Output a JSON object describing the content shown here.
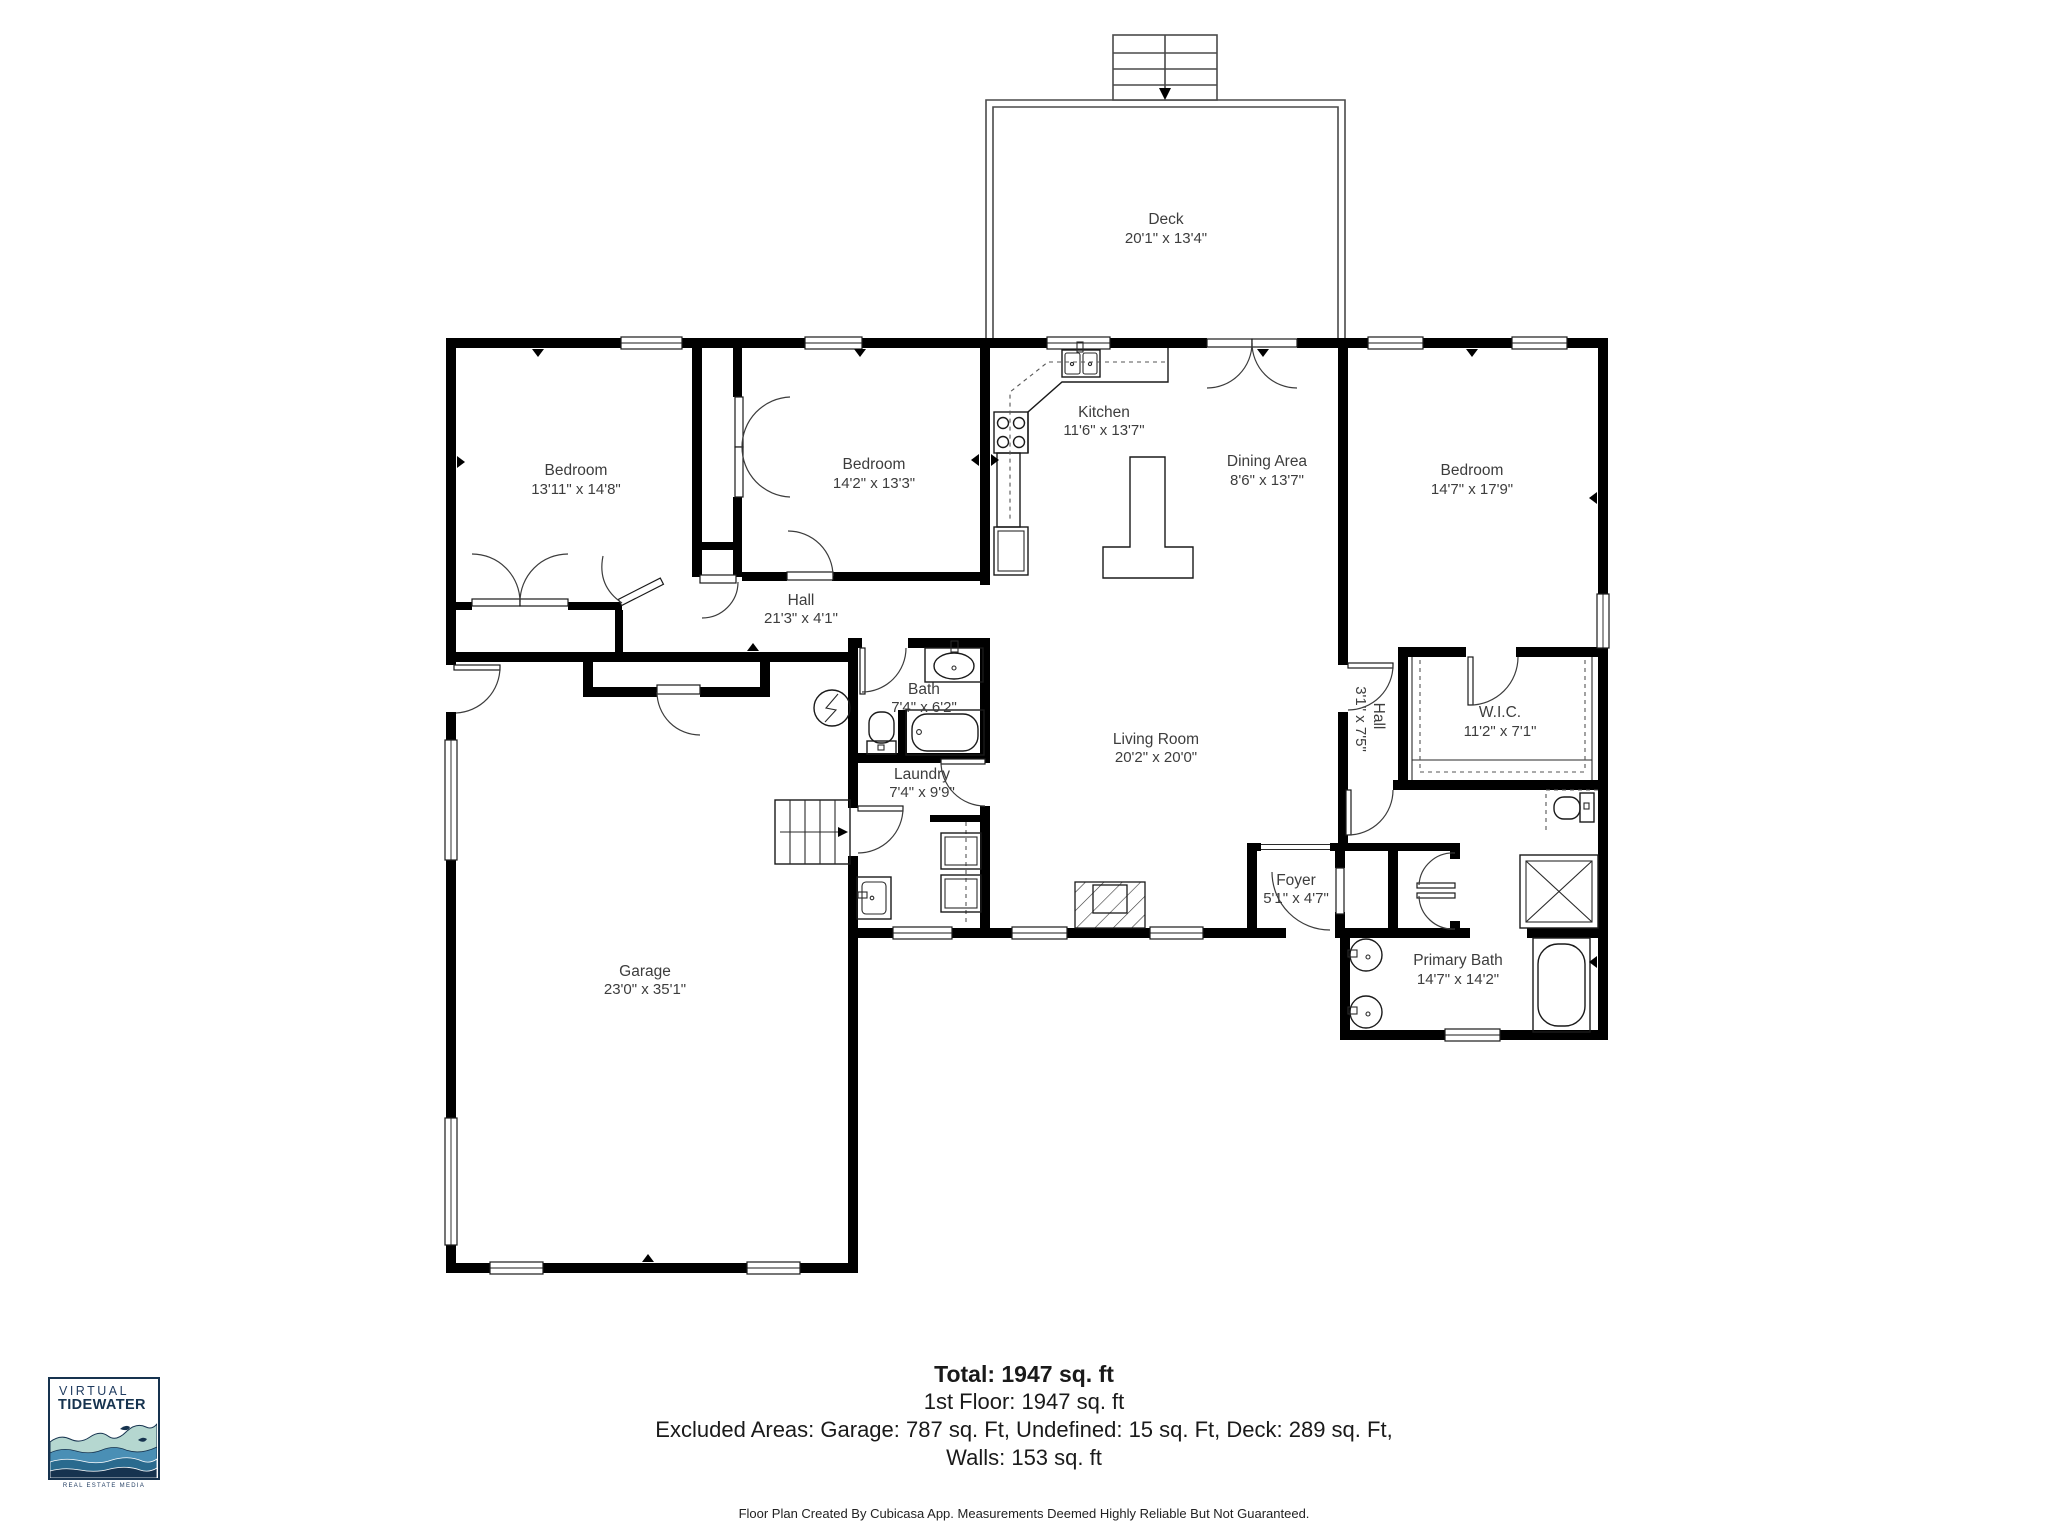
{
  "floor_plan": {
    "rooms": {
      "deck": {
        "name": "Deck",
        "dims": "20'1\" x 13'4\""
      },
      "bedroom1": {
        "name": "Bedroom",
        "dims": "13'11\" x 14'8\""
      },
      "bedroom2": {
        "name": "Bedroom",
        "dims": "14'2\" x 13'3\""
      },
      "kitchen": {
        "name": "Kitchen",
        "dims": "11'6\" x 13'7\""
      },
      "dining": {
        "name": "Dining Area",
        "dims": "8'6\" x 13'7\""
      },
      "bedroom3": {
        "name": "Bedroom",
        "dims": "14'7\" x 17'9\""
      },
      "hall": {
        "name": "Hall",
        "dims": "21'3\" x 4'1\""
      },
      "bath": {
        "name": "Bath",
        "dims": "7'4\" x 6'2\""
      },
      "laundry": {
        "name": "Laundry",
        "dims": "7'4\" x 9'9\""
      },
      "living": {
        "name": "Living Room",
        "dims": "20'2\" x 20'0\""
      },
      "hall2": {
        "name": "Hall",
        "dims": "3'1\" x 7'5\""
      },
      "wic": {
        "name": "W.I.C.",
        "dims": "11'2\" x 7'1\""
      },
      "foyer": {
        "name": "Foyer",
        "dims": "5'1\" x 4'7\""
      },
      "primary": {
        "name": "Primary Bath",
        "dims": "14'7\" x 14'2\""
      },
      "garage": {
        "name": "Garage",
        "dims": "23'0\" x 35'1\""
      }
    }
  },
  "summary": {
    "total": "Total: 1947 sq. ft",
    "floor1": "1st Floor: 1947 sq. ft",
    "excluded": "Excluded Areas: Garage: 787 sq. Ft, Undefined: 15 sq. Ft, Deck: 289 sq. Ft,",
    "walls": "Walls: 153 sq. ft",
    "footer": "Floor Plan Created By Cubicasa App. Measurements Deemed Highly Reliable But Not Guaranteed."
  },
  "logo": {
    "line1": "VIRTUAL",
    "line2": "TIDEWATER",
    "caption": "REAL ESTATE MEDIA"
  },
  "colors": {
    "wall": "#000000",
    "label_text": "#3d3d3d",
    "logo_navy": "#16334f",
    "wave_light": "#b5d7d0",
    "wave_mid": "#4a8fb5",
    "wave_deep": "#2a6a8e"
  }
}
